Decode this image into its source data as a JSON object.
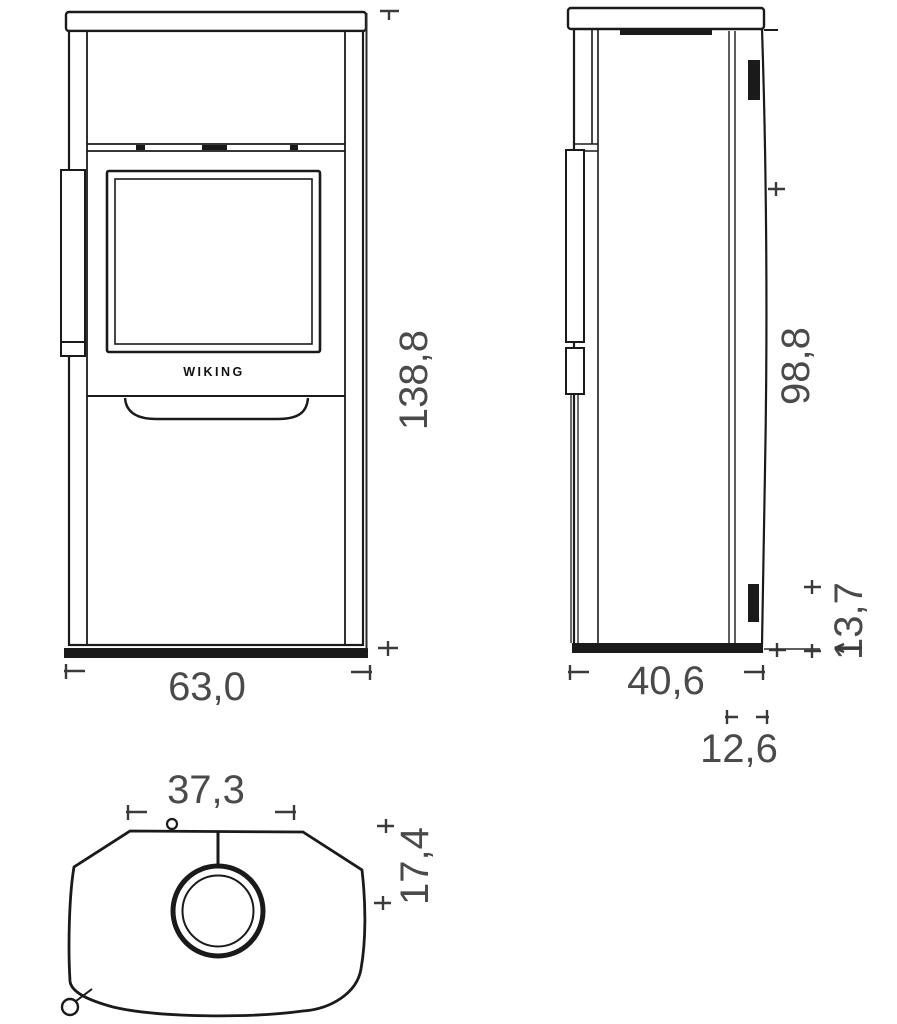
{
  "drawing": {
    "background_color": "#ffffff",
    "line_color": "#1a1a1a",
    "dimension_text_color": "#4a4a4a",
    "brand": {
      "logo_text": "WIKING"
    },
    "dims": {
      "front_height": "138,8",
      "front_width": "63,0",
      "side_outlet_height": "98,8",
      "side_depth": "40,6",
      "side_lower_outlet_height": "13,7",
      "side_rear_offset": "12,6",
      "top_flue_width": "37,3",
      "top_flue_depth": "17,4"
    }
  }
}
